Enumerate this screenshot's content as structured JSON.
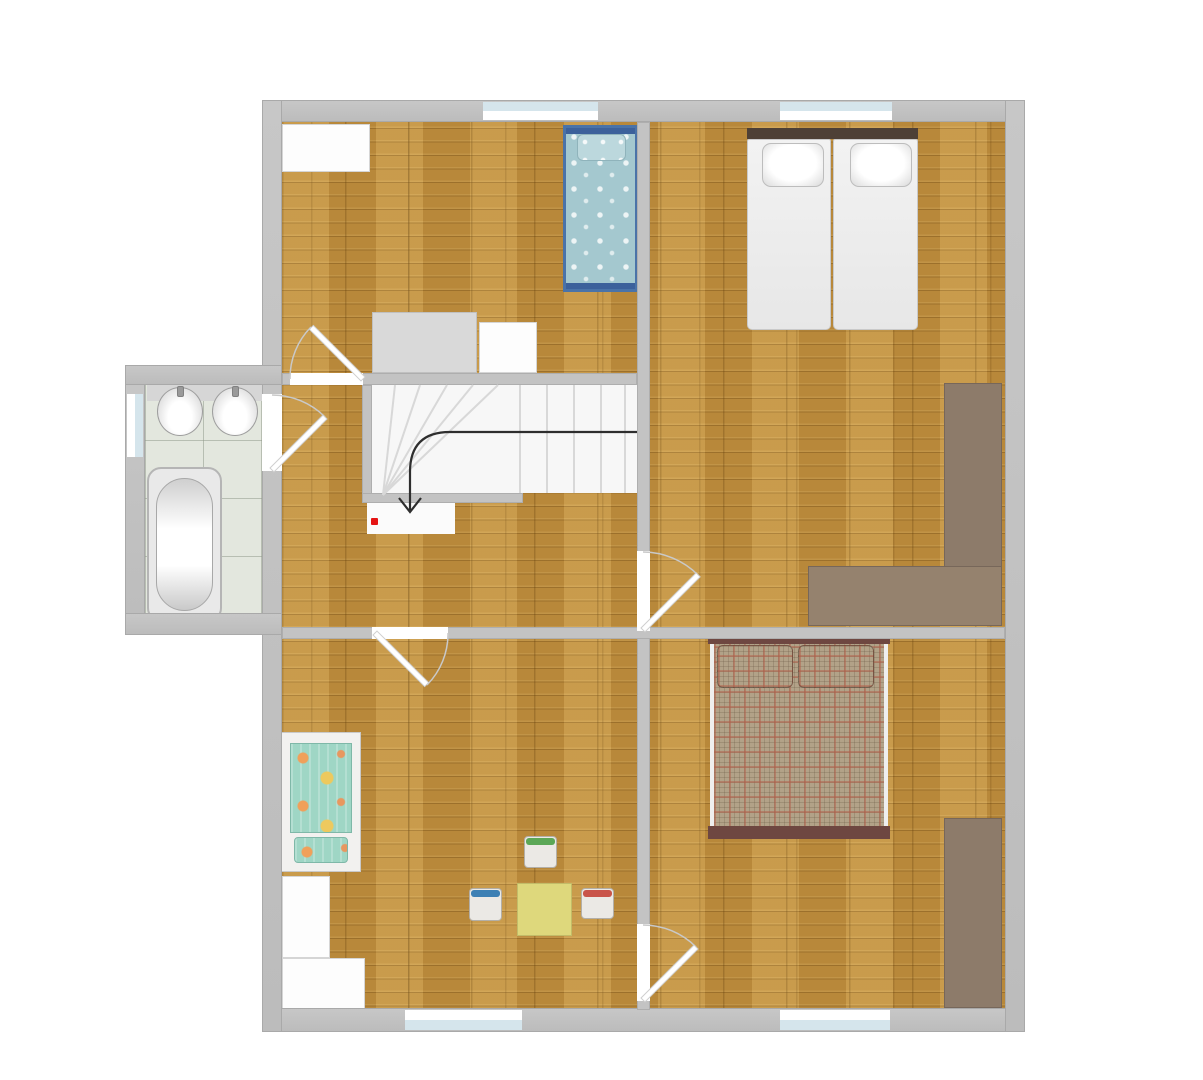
{
  "scene": {
    "type": "floor-plan",
    "view": "top-down",
    "background": "#ffffff",
    "storey_features": [
      "winder staircase going down",
      "hallway",
      "bathroom annex on left side"
    ]
  },
  "colors": {
    "wall": "#c2c2c2",
    "wall_border": "#a9a9a9",
    "wood_floor": "#c29140",
    "tile_floor": "#e3e7de",
    "stair_bg": "#f7f7f7",
    "landing_bg": "#fbfbfb",
    "window_glass": "#d5e5ec",
    "window_frame": "#ffffff",
    "red_marker": "#e51414",
    "walk_line": "#2e2e2e",
    "tread_line": "#d8d8d8",
    "door_arc": "#c9c9c9",
    "door_leaf": "#ffffff",
    "blue_bed_frame": "#4a73a8",
    "blue_bed_duvet": "#a4c8cf",
    "blue_bed_pillow": "#bcd8dd",
    "white_bed_headboard": "#4e4036",
    "white_bed_mattress": "#ededed",
    "plaid_bed_frame": "#6e4741",
    "plaid_base": "#b2a288",
    "plaid_stripe": "#b35f4a",
    "wardrobe_brown": "#8d7b6a",
    "desk_brown": "#95826e",
    "crib_base": "#9fd6c5",
    "crib_accent_orange": "#f0a05a",
    "crib_accent_yellow": "#edc95e",
    "play_table_yellow": "#ded87c",
    "chair_green": "#5ba757",
    "chair_blue": "#3d80b4",
    "chair_red": "#c9544a",
    "furniture_white": "#fdfdfd",
    "furniture_gray": "#d9d9d9",
    "counter_gray": "#d6d6d6"
  },
  "rooms": [
    {
      "id": "bedroom-upper-left",
      "contents": [
        "white wardrobe",
        "gray dresser",
        "white dresser",
        "blue single bed with dotted duvet"
      ]
    },
    {
      "id": "bedroom-upper-right",
      "contents": [
        "white double bed with two pillows",
        "L-shaped corner desk/wardrobe"
      ]
    },
    {
      "id": "bedroom-lower-right",
      "contents": [
        "double bed with plaid duvet and two plaid pillows",
        "brown wardrobe"
      ]
    },
    {
      "id": "children-room-lower-left",
      "contents": [
        "toddler bed with patterned bedding",
        "two white dressers",
        "yellow play table",
        "green chair",
        "blue chair",
        "red chair"
      ]
    },
    {
      "id": "bathroom",
      "contents": [
        "two round sinks",
        "bathtub"
      ]
    },
    {
      "id": "hallway",
      "contents": [
        "winder staircase with down arrow",
        "red position marker"
      ]
    }
  ],
  "stairs": {
    "type": "winder",
    "direction": "down",
    "marker": "red dot on lower landing"
  },
  "windows": {
    "count": 5,
    "locations": [
      "top wall left bedroom",
      "top wall right bedroom",
      "bottom wall children room",
      "bottom wall lower-right bedroom",
      "bathroom left wall"
    ]
  },
  "doors": {
    "count": 5,
    "locations": [
      "upper-left bedroom",
      "bathroom",
      "upper-right bedroom",
      "lower-right bedroom",
      "children room"
    ]
  }
}
